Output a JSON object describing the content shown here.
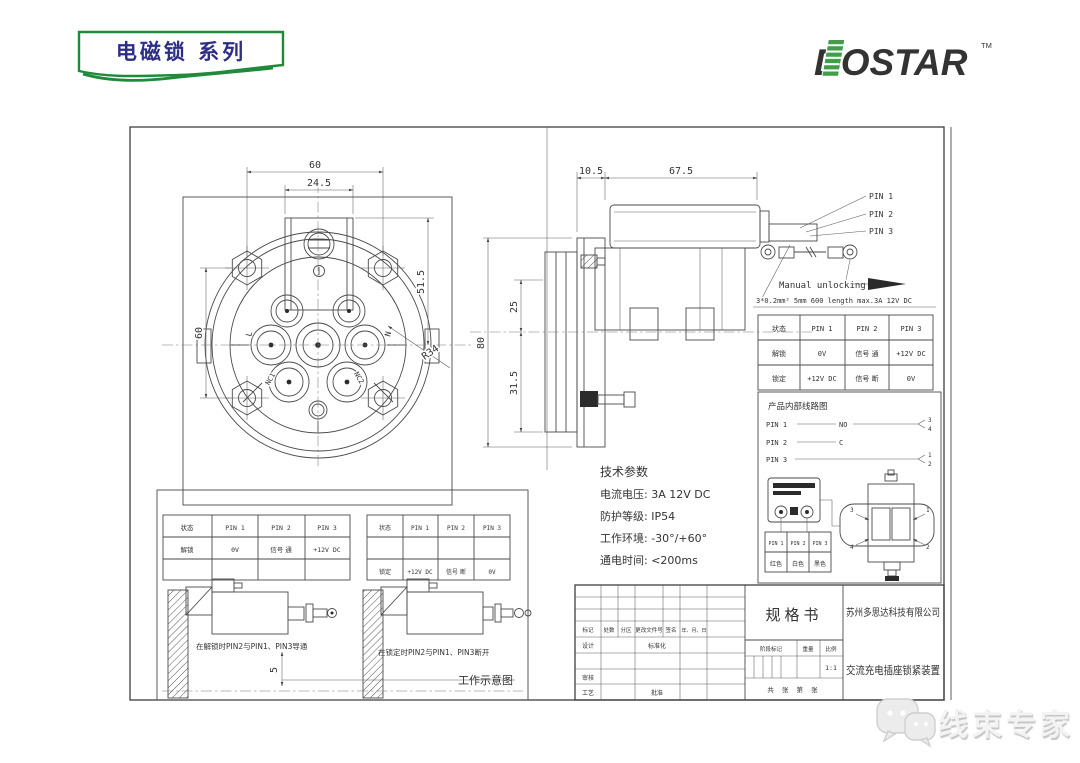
{
  "banner": {
    "title": "电磁锁 系列"
  },
  "logo": {
    "text": "DOSTAR",
    "tm": "TM"
  },
  "drawing": {
    "front_view": {
      "dim_top_width": "60",
      "dim_tab_width": "24.5",
      "dim_right_height": "51.5",
      "dim_left_height": "60",
      "radius_label": "R34",
      "pin_l": "L",
      "pin_n": "N",
      "pin_nc1": "NC1",
      "pin_nc2": "NC2"
    },
    "side_view": {
      "dim_flange": "10.5",
      "dim_body_len": "67.5",
      "dim_total_height": "80",
      "dim_upper": "25",
      "dim_lower": "31.5",
      "pin1": "PIN 1",
      "pin2": "PIN 2",
      "pin3": "PIN 3",
      "manual_unlocking": "Manual unlocking",
      "wire_spec": "3*0.2mm² 5mm 600 length  max.3A 12V DC"
    },
    "status_table": {
      "headers": [
        "状态",
        "PIN 1",
        "PIN 2",
        "PIN 3"
      ],
      "rows": [
        [
          "解锁",
          "0V",
          "信号 通",
          "+12V DC"
        ],
        [
          "锁定",
          "+12V DC",
          "信号 断",
          "0V"
        ]
      ]
    },
    "circuit": {
      "title": "产品内部线路图",
      "pin1": "PIN 1",
      "pin2": "PIN 2",
      "pin3": "PIN 3",
      "no_label": "NO",
      "c_label": "C",
      "t1": "1",
      "t2": "2",
      "t3": "3",
      "t4": "4",
      "wire_colors": [
        "红色",
        "白色",
        "黑色"
      ]
    },
    "tech": {
      "title": "技术参数",
      "lines": [
        "电流电压: 3A 12V DC",
        "防护等级:  IP54",
        "工作环境: -30°/+60°",
        "通电时间:  <200ms"
      ]
    },
    "work": {
      "caption_unlock": "在解锁时PIN2与PIN1、PIN3导通",
      "caption_lock": "在锁定时PIN2与PIN1、PIN3断开",
      "dim_gap": "5",
      "label": "工作示意图"
    },
    "title_block": {
      "spec": "规格书",
      "company": "苏州多思达科技有限公司",
      "product": "交流充电插座锁紧装置",
      "mark": "标记",
      "count": "处数",
      "zone": "分区",
      "doc_no": "更改文件号",
      "sign": "签名",
      "date": "年、月、日",
      "design": "设计",
      "standardize": "标准化",
      "check": "审核",
      "craft": "工艺",
      "approve": "批准",
      "stage": "阶段标记",
      "weight": "重量",
      "scale": "比例",
      "scale_val": "1:1",
      "sheet": "共  张  第  张"
    }
  },
  "watermark": {
    "text": "线束专家"
  }
}
